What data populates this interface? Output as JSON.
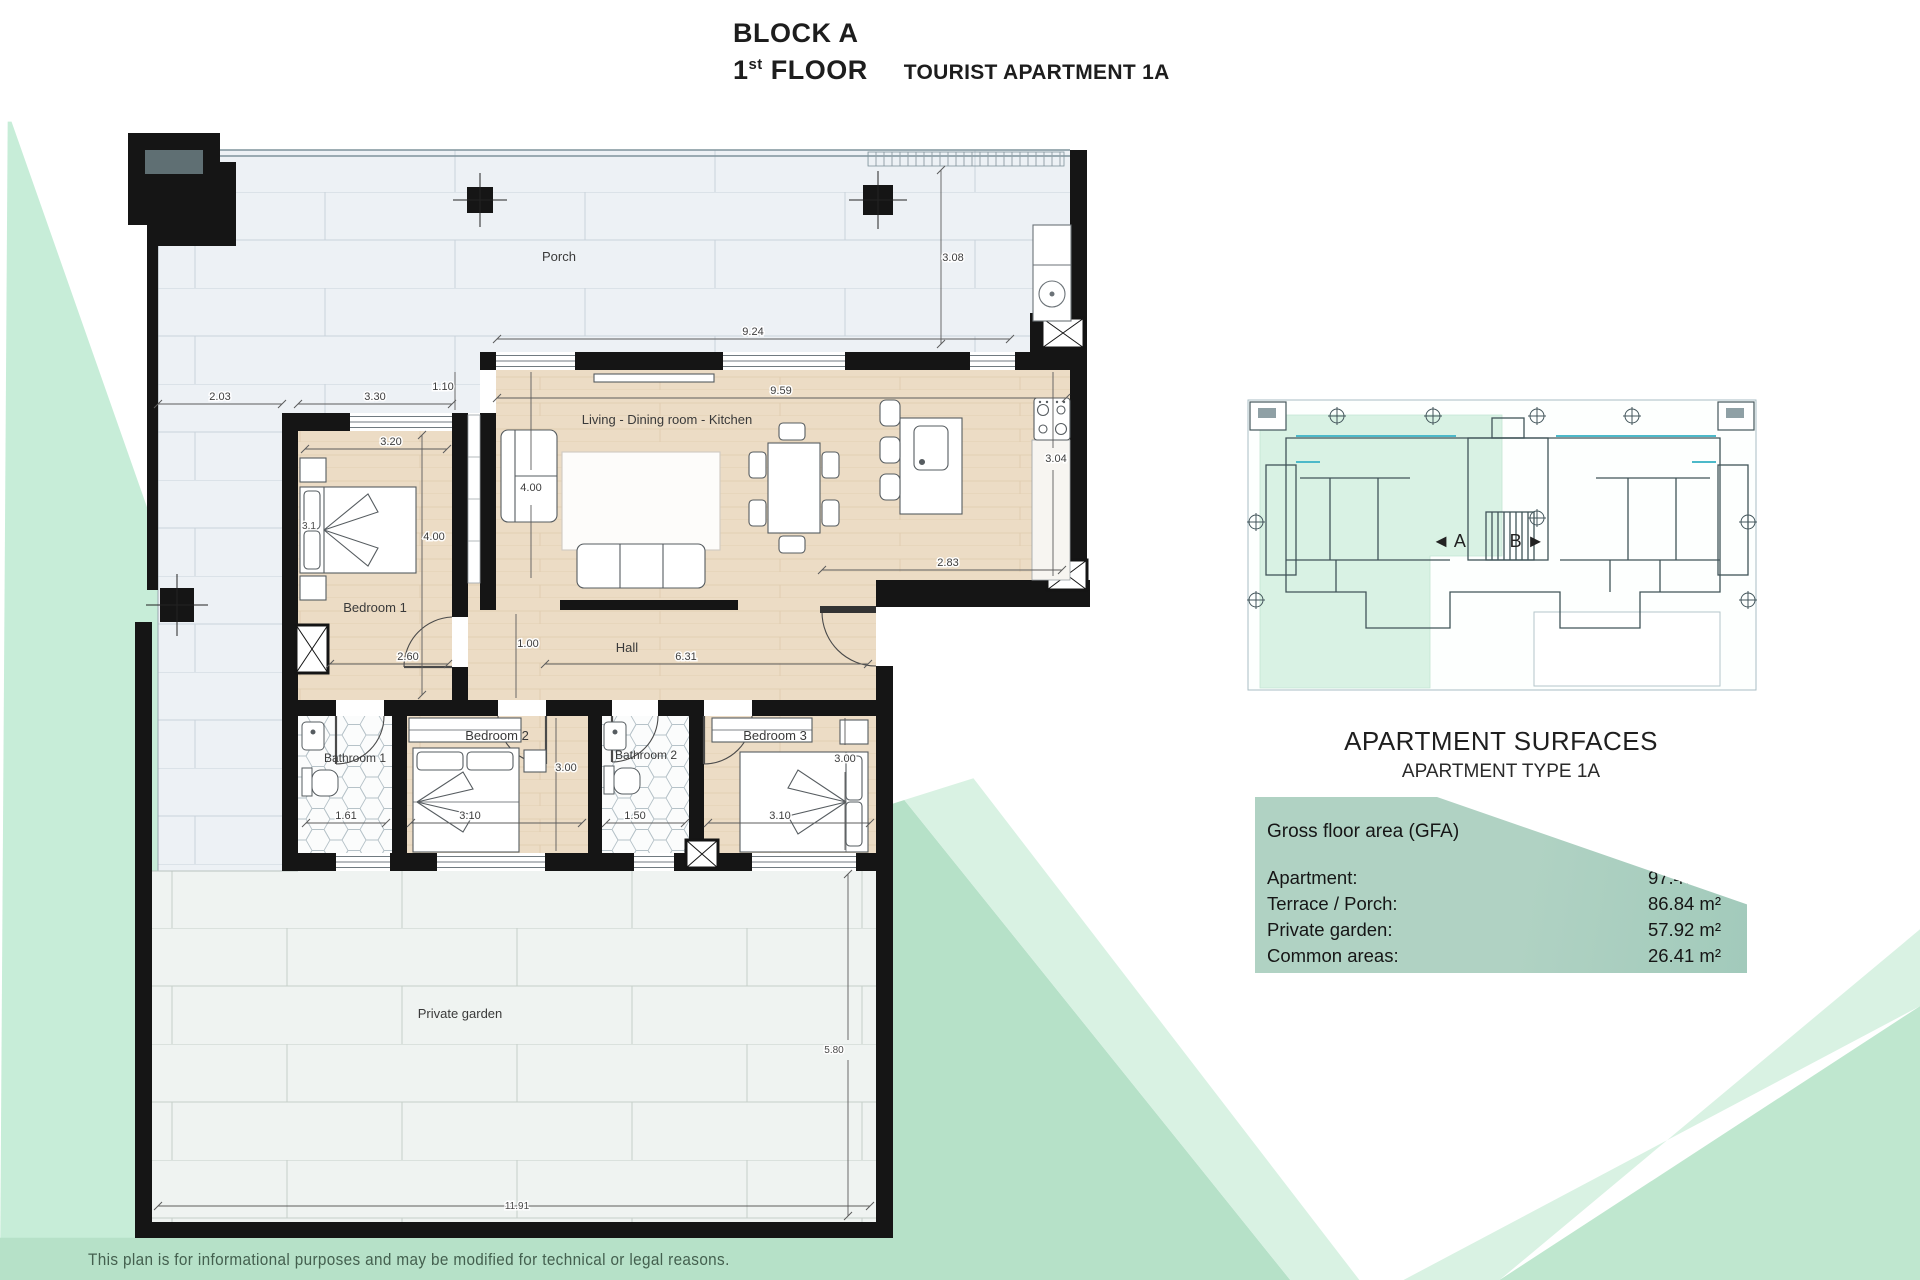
{
  "title": {
    "block": "BLOCK A",
    "floor_number": "1",
    "floor_ordinal": "st",
    "floor_word": "FLOOR",
    "apartment": "TOURIST APARTMENT 1A"
  },
  "plan": {
    "rooms": {
      "porch": "Porch",
      "living": "Living - Dining room - Kitchen",
      "bedroom1": "Bedroom 1",
      "hall": "Hall",
      "bathroom1": "Bathroom 1",
      "bedroom2": "Bedroom 2",
      "bathroom2": "Bathroom 2",
      "bedroom3": "Bedroom 3",
      "garden": "Private garden"
    },
    "dimensions": {
      "porch_width": "9.24",
      "porch_depth": "3.08",
      "left_terrace_width": "2.03",
      "bed1_outer_width": "3.30",
      "wall_jog": "1.10",
      "living_width": "9.59",
      "bed1_inner_width": "3.20",
      "bed1_bed": "3.1",
      "bed1_depth": "4.00",
      "living_depth": "4.00",
      "bed1_bottom": "2.60",
      "hall_width": "1.00",
      "hall_length": "6.31",
      "bed2_depth": "3.00",
      "bath1_width": "1.61",
      "bed2_width": "3.10",
      "bath2_width": "1.50",
      "bed3_width": "3.10",
      "bed3_depth": "3.00",
      "entry_width": "2.83",
      "kitchen_depth": "3.04",
      "garden_depth": "5.80",
      "garden_width": "11.91"
    }
  },
  "key_plan": {
    "unit_a": "◄ A",
    "unit_b": "B ►"
  },
  "surfaces": {
    "title": "APARTMENT SURFACES",
    "subtitle": "APARTMENT TYPE 1A",
    "header": "Gross floor area (GFA)",
    "rows": [
      {
        "label": "Apartment:",
        "value": "97.47 m²"
      },
      {
        "label": "Terrace / Porch:",
        "value": "86.84 m²"
      },
      {
        "label": "Private garden:",
        "value": "57.92 m²"
      },
      {
        "label": "Common areas:",
        "value": "26.41 m²"
      }
    ]
  },
  "footer": {
    "disclaimer": "This plan is for informational purposes and may be modified for technical or legal reasons."
  },
  "colors": {
    "mint_light": "#c7edd8",
    "mint_band": "#b6e1c8",
    "panel_sage": "#aed0c2",
    "wall_black": "#151515",
    "wood_floor": "#ecdcc5",
    "porch_tile": "#edf1f5"
  }
}
